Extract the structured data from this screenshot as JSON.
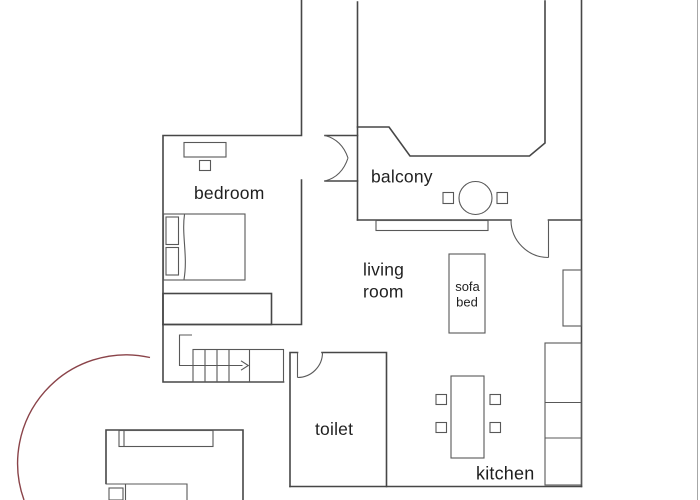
{
  "floorplan": {
    "type": "apartment-floor-plan",
    "rooms": {
      "bedroom": {
        "label": "bedroom"
      },
      "balcony": {
        "label": "balcony"
      },
      "living_room": {
        "label_line1": "living",
        "label_line2": "room"
      },
      "toilet": {
        "label": "toilet"
      },
      "kitchen": {
        "label": "kitchen"
      },
      "sofa_bed": {
        "label_line1": "sofa",
        "label_line2": "bed"
      }
    },
    "furniture": [
      "double-bed",
      "bed-pillows",
      "desk",
      "desk-chair",
      "wardrobe",
      "stairs",
      "stair-direction-arrow",
      "balcony-round-table",
      "balcony-stools",
      "window",
      "sofa-bed",
      "radiator",
      "kitchen-counter",
      "dining-table",
      "dining-chairs",
      "single-bed",
      "closet",
      "entry-door-swing"
    ],
    "colors": {
      "background": "#ffffff",
      "wall_line": "#474747",
      "furniture_line": "#585858",
      "text": "#1f1f1f",
      "entry_door_swing": "#8a4349",
      "frame_edge": "#a7a7a7"
    }
  }
}
